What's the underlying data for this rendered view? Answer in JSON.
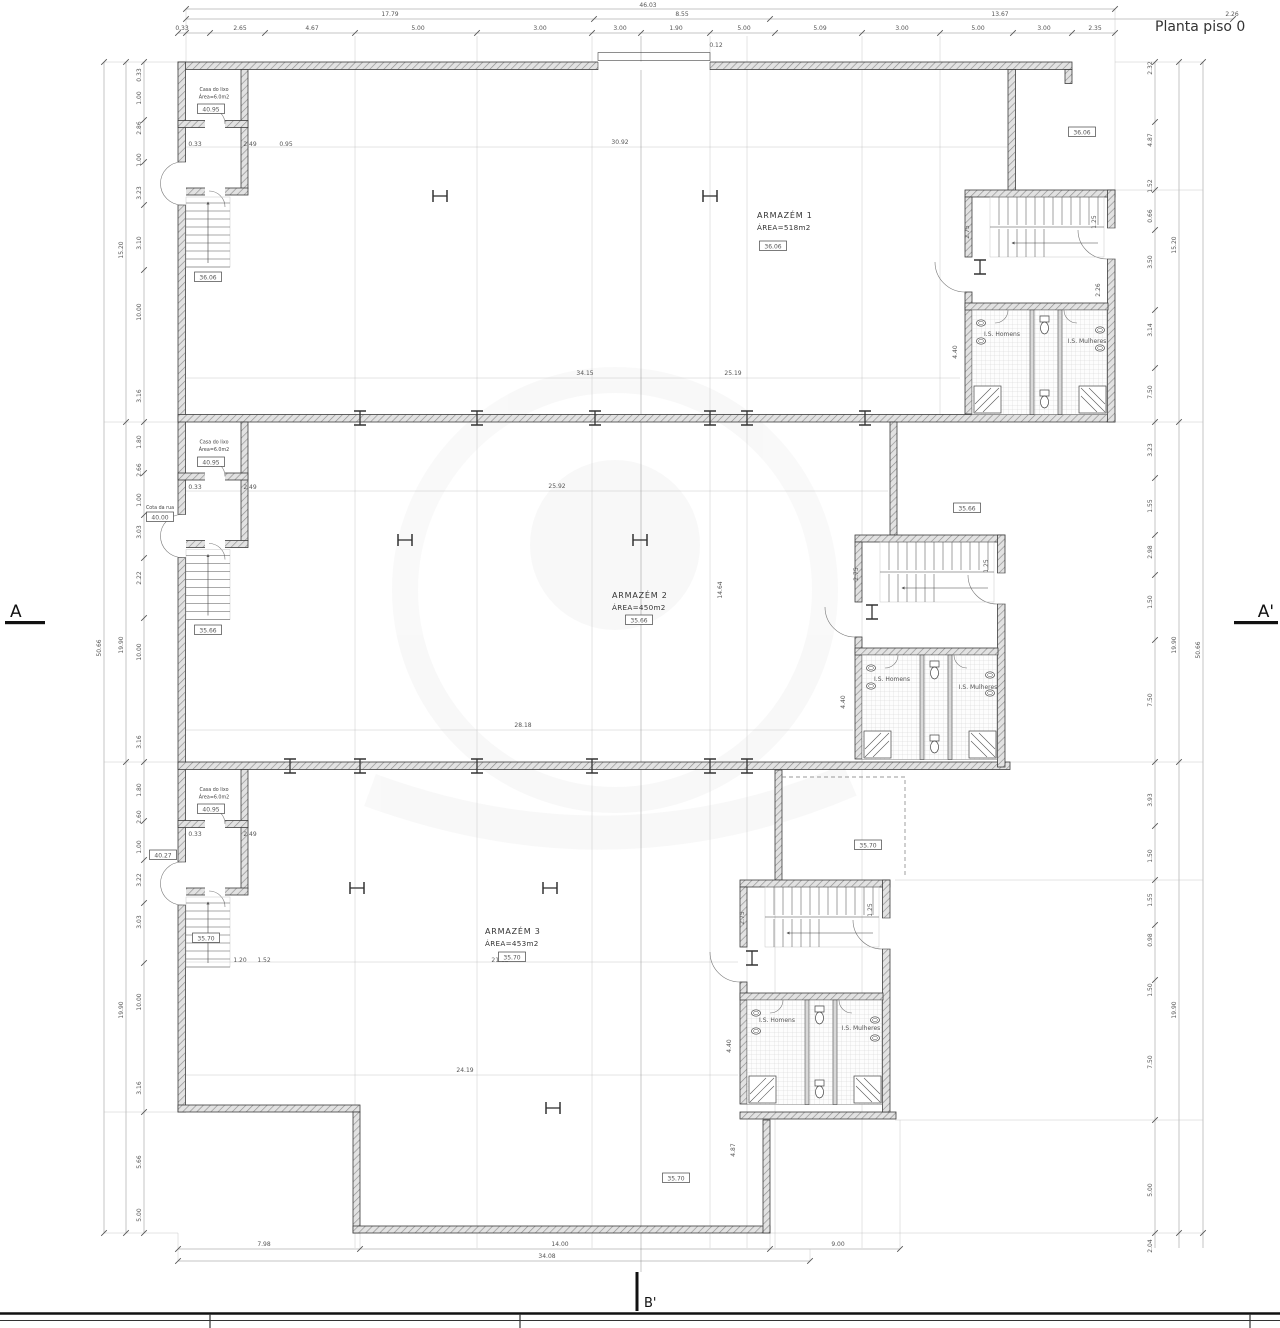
{
  "title": "Planta piso 0",
  "markers": {
    "a": "A",
    "a_prime": "A'",
    "b_prime": "B'"
  },
  "units": [
    {
      "name": "ARMAZÉM 1",
      "area": "ÁREA=518m2"
    },
    {
      "name": "ARMAZÉM 2",
      "area": "ÁREA=450m2"
    },
    {
      "name": "ARMAZÉM 3",
      "area": "ÁREA=453m2"
    }
  ],
  "side_room": {
    "line1": "Casa do lixo",
    "line2": "Área=6.0m2"
  },
  "street": {
    "label": "Cota da rua"
  },
  "wc": {
    "men": "I.S. Homens",
    "women": "I.S. Mulheres"
  },
  "cotas": [
    {
      "x": 773,
      "y": 246,
      "v": "36.06"
    },
    {
      "x": 639,
      "y": 620,
      "v": "35.66"
    },
    {
      "x": 512,
      "y": 957,
      "v": "35.70"
    },
    {
      "x": 211,
      "y": 109,
      "v": "40.95"
    },
    {
      "x": 211,
      "y": 462,
      "v": "40.95"
    },
    {
      "x": 211,
      "y": 809,
      "v": "40.95"
    },
    {
      "x": 160,
      "y": 517,
      "v": "40.00"
    },
    {
      "x": 163,
      "y": 855,
      "v": "40.27"
    },
    {
      "x": 208,
      "y": 277,
      "v": "36.06"
    },
    {
      "x": 208,
      "y": 630,
      "v": "35.66"
    },
    {
      "x": 206,
      "y": 938,
      "v": "35.70"
    },
    {
      "x": 868,
      "y": 845,
      "v": "35.70"
    },
    {
      "x": 676,
      "y": 1178,
      "v": "35.70"
    },
    {
      "x": 1082,
      "y": 132,
      "v": "36.06"
    },
    {
      "x": 967,
      "y": 508,
      "v": "35.66"
    }
  ],
  "dims": [
    {
      "x": 648,
      "y": 7,
      "v": "46.03"
    },
    {
      "x": 390,
      "y": 16,
      "v": "17.79"
    },
    {
      "x": 682,
      "y": 16,
      "v": "8.55"
    },
    {
      "x": 1000,
      "y": 16,
      "v": "13.67"
    },
    {
      "x": 1232,
      "y": 16,
      "v": "2.26"
    },
    {
      "x": 182,
      "y": 30,
      "v": "0.33"
    },
    {
      "x": 240,
      "y": 30,
      "v": "2.65"
    },
    {
      "x": 312,
      "y": 30,
      "v": "4.67"
    },
    {
      "x": 418,
      "y": 30,
      "v": "5.00"
    },
    {
      "x": 540,
      "y": 30,
      "v": "3.00"
    },
    {
      "x": 620,
      "y": 30,
      "v": "3.00"
    },
    {
      "x": 676,
      "y": 30,
      "v": "1.90"
    },
    {
      "x": 744,
      "y": 30,
      "v": "5.00"
    },
    {
      "x": 820,
      "y": 30,
      "v": "5.09"
    },
    {
      "x": 902,
      "y": 30,
      "v": "3.00"
    },
    {
      "x": 978,
      "y": 30,
      "v": "5.00"
    },
    {
      "x": 1044,
      "y": 30,
      "v": "3.00"
    },
    {
      "x": 1095,
      "y": 30,
      "v": "2.35"
    },
    {
      "x": 716,
      "y": 47,
      "v": "0.12"
    },
    {
      "x": 195,
      "y": 146,
      "v": "0.33"
    },
    {
      "x": 250,
      "y": 146,
      "v": "2.49"
    },
    {
      "x": 286,
      "y": 146,
      "v": "0.95"
    },
    {
      "x": 195,
      "y": 489,
      "v": "0.33"
    },
    {
      "x": 250,
      "y": 489,
      "v": "2.49"
    },
    {
      "x": 195,
      "y": 836,
      "v": "0.33"
    },
    {
      "x": 250,
      "y": 836,
      "v": "2.49"
    },
    {
      "x": 101,
      "y": 648,
      "v": "50.66",
      "r": 1
    },
    {
      "x": 123,
      "y": 250,
      "v": "15.20",
      "r": 1
    },
    {
      "x": 123,
      "y": 645,
      "v": "19.90",
      "r": 1
    },
    {
      "x": 123,
      "y": 1010,
      "v": "19.90",
      "r": 1
    },
    {
      "x": 141,
      "y": 75,
      "v": "0.33",
      "r": 1
    },
    {
      "x": 141,
      "y": 98,
      "v": "1.00",
      "r": 1
    },
    {
      "x": 141,
      "y": 128,
      "v": "2.86",
      "r": 1
    },
    {
      "x": 141,
      "y": 160,
      "v": "1.00",
      "r": 1
    },
    {
      "x": 141,
      "y": 193,
      "v": "3.23",
      "r": 1
    },
    {
      "x": 141,
      "y": 243,
      "v": "3.10",
      "r": 1
    },
    {
      "x": 141,
      "y": 312,
      "v": "10.00",
      "r": 1
    },
    {
      "x": 141,
      "y": 396,
      "v": "3.16",
      "r": 1
    },
    {
      "x": 141,
      "y": 442,
      "v": "1.80",
      "r": 1
    },
    {
      "x": 141,
      "y": 470,
      "v": "2.66",
      "r": 1
    },
    {
      "x": 141,
      "y": 500,
      "v": "1.00",
      "r": 1
    },
    {
      "x": 141,
      "y": 532,
      "v": "3.03",
      "r": 1
    },
    {
      "x": 141,
      "y": 578,
      "v": "2.22",
      "r": 1
    },
    {
      "x": 141,
      "y": 652,
      "v": "10.00",
      "r": 1
    },
    {
      "x": 141,
      "y": 742,
      "v": "3.16",
      "r": 1
    },
    {
      "x": 141,
      "y": 790,
      "v": "1.80",
      "r": 1
    },
    {
      "x": 141,
      "y": 817,
      "v": "2.60",
      "r": 1
    },
    {
      "x": 141,
      "y": 847,
      "v": "1.00",
      "r": 1
    },
    {
      "x": 141,
      "y": 880,
      "v": "3.22",
      "r": 1
    },
    {
      "x": 141,
      "y": 922,
      "v": "3.03",
      "r": 1
    },
    {
      "x": 141,
      "y": 1002,
      "v": "10.00",
      "r": 1
    },
    {
      "x": 141,
      "y": 1088,
      "v": "3.16",
      "r": 1
    },
    {
      "x": 141,
      "y": 1162,
      "v": "5.66",
      "r": 1
    },
    {
      "x": 141,
      "y": 1215,
      "v": "5.00",
      "r": 1
    },
    {
      "x": 1152,
      "y": 68,
      "v": "2.32",
      "r": 1
    },
    {
      "x": 1152,
      "y": 140,
      "v": "4.87",
      "r": 1
    },
    {
      "x": 1152,
      "y": 186,
      "v": "1.52",
      "r": 1
    },
    {
      "x": 1152,
      "y": 216,
      "v": "0.66",
      "r": 1
    },
    {
      "x": 1152,
      "y": 262,
      "v": "3.50",
      "r": 1
    },
    {
      "x": 1152,
      "y": 330,
      "v": "3.14",
      "r": 1
    },
    {
      "x": 1152,
      "y": 392,
      "v": "7.50",
      "r": 1
    },
    {
      "x": 1152,
      "y": 450,
      "v": "3.23",
      "r": 1
    },
    {
      "x": 1152,
      "y": 506,
      "v": "1.55",
      "r": 1
    },
    {
      "x": 1152,
      "y": 552,
      "v": "2.98",
      "r": 1
    },
    {
      "x": 1152,
      "y": 602,
      "v": "1.50",
      "r": 1
    },
    {
      "x": 1152,
      "y": 700,
      "v": "7.50",
      "r": 1
    },
    {
      "x": 1152,
      "y": 800,
      "v": "3.93",
      "r": 1
    },
    {
      "x": 1152,
      "y": 856,
      "v": "1.50",
      "r": 1
    },
    {
      "x": 1152,
      "y": 900,
      "v": "1.55",
      "r": 1
    },
    {
      "x": 1152,
      "y": 940,
      "v": "0.98",
      "r": 1
    },
    {
      "x": 1152,
      "y": 990,
      "v": "1.50",
      "r": 1
    },
    {
      "x": 1152,
      "y": 1062,
      "v": "7.50",
      "r": 1
    },
    {
      "x": 1152,
      "y": 1190,
      "v": "5.00",
      "r": 1
    },
    {
      "x": 1152,
      "y": 1246,
      "v": "2.04",
      "r": 1
    },
    {
      "x": 1176,
      "y": 245,
      "v": "15.20",
      "r": 1
    },
    {
      "x": 1176,
      "y": 645,
      "v": "19.90",
      "r": 1
    },
    {
      "x": 1176,
      "y": 1010,
      "v": "19.90",
      "r": 1
    },
    {
      "x": 1200,
      "y": 650,
      "v": "50.66",
      "r": 1
    },
    {
      "x": 264,
      "y": 1246,
      "v": "7.98"
    },
    {
      "x": 560,
      "y": 1246,
      "v": "14.00"
    },
    {
      "x": 838,
      "y": 1246,
      "v": "9.00"
    },
    {
      "x": 547,
      "y": 1258,
      "v": "34.08"
    },
    {
      "x": 620,
      "y": 144,
      "v": "30.92"
    },
    {
      "x": 585,
      "y": 375,
      "v": "34.15"
    },
    {
      "x": 733,
      "y": 375,
      "v": "25.19"
    },
    {
      "x": 557,
      "y": 488,
      "v": "25.92"
    },
    {
      "x": 523,
      "y": 727,
      "v": "28.18"
    },
    {
      "x": 500,
      "y": 962,
      "v": "21.12"
    },
    {
      "x": 240,
      "y": 962,
      "v": "1.20"
    },
    {
      "x": 264,
      "y": 962,
      "v": "1.52"
    },
    {
      "x": 465,
      "y": 1072,
      "v": "24.19"
    },
    {
      "x": 735,
      "y": 1150,
      "v": "4.87",
      "r": 1
    },
    {
      "x": 722,
      "y": 590,
      "v": "14.64",
      "r": 1
    },
    {
      "x": 969,
      "y": 232,
      "v": "2.75",
      "r": 1
    },
    {
      "x": 1096,
      "y": 222,
      "v": "1.25",
      "r": 1
    },
    {
      "x": 1100,
      "y": 290,
      "v": "2.26",
      "r": 1
    },
    {
      "x": 957,
      "y": 352,
      "v": "4.40",
      "r": 1
    },
    {
      "x": 858,
      "y": 574,
      "v": "2.75",
      "r": 1
    },
    {
      "x": 988,
      "y": 566,
      "v": "1.25",
      "r": 1
    },
    {
      "x": 845,
      "y": 702,
      "v": "4.40",
      "r": 1
    },
    {
      "x": 744,
      "y": 918,
      "v": "2.75",
      "r": 1
    },
    {
      "x": 872,
      "y": 910,
      "v": "1.25",
      "r": 1
    },
    {
      "x": 731,
      "y": 1046,
      "v": "4.40",
      "r": 1
    },
    {
      "x": 1002,
      "y": 336,
      "v": "I.S. Homens",
      "s": 4
    },
    {
      "x": 1087,
      "y": 343,
      "v": "I.S. Mulheres",
      "s": 4
    },
    {
      "x": 892,
      "y": 681,
      "v": "I.S. Homens",
      "s": 4
    },
    {
      "x": 978,
      "y": 689,
      "v": "I.S. Mulheres",
      "s": 4
    },
    {
      "x": 777,
      "y": 1022,
      "v": "I.S. Homens",
      "s": 4
    },
    {
      "x": 861,
      "y": 1030,
      "v": "I.S. Mulheres",
      "s": 4
    }
  ]
}
